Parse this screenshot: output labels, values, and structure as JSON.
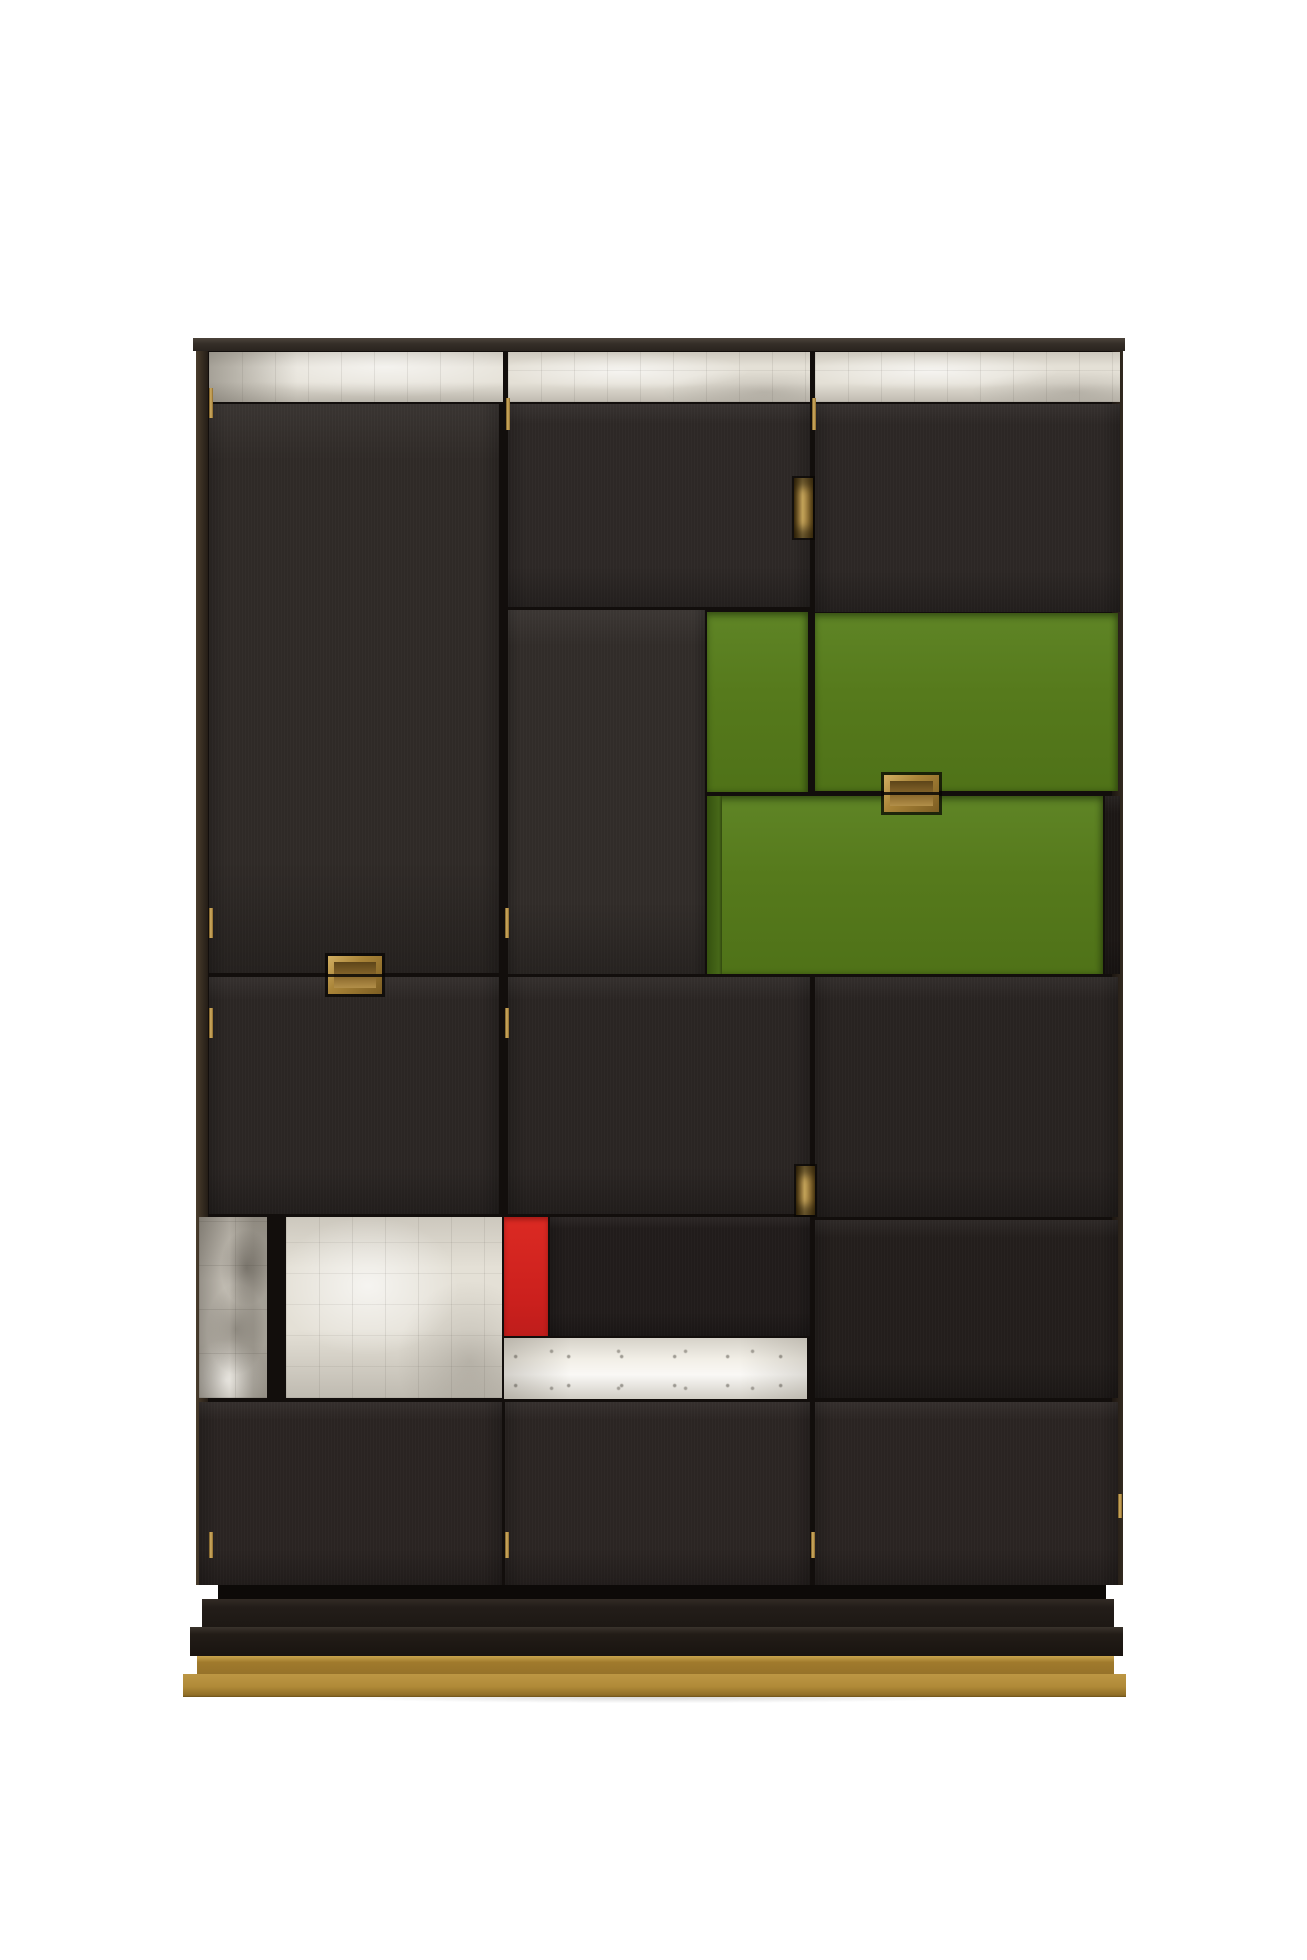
{
  "scene": {
    "type": "product-photograph",
    "description": "Tall dark-stained wood cabinet photographed on a white background, with a Mondrian-style patchwork facade: a silver-leaf band across the top, green lacquered doors and a green drawer at the upper right, silver-leaf panels and a bright silver strip at the lower left, a small red lacquer panel in the center, recessed brass handles and hinge pins, on a stepped black plinth with a brass foot.",
    "background_color": "#ffffff"
  },
  "cabinet": {
    "structure": {
      "columns": 3,
      "top_band_material": "silver leaf",
      "body_material": "ebonized dark-stained wood",
      "accent_panels": [
        "green lacquer upper door (small)",
        "green lacquer upper door (large)",
        "green lacquer drawer front",
        "red lacquer panel",
        "silver leaf mottled panel (lower left)",
        "silver leaf bright panel (lower left)",
        "silver leaf bright strip (lower middle)"
      ],
      "base": "stepped dark plinth with brass foot"
    },
    "hardware": {
      "finish": "brass",
      "handles": 4,
      "hinge_pins": 11
    }
  },
  "palette": {
    "background": "#ffffff",
    "wood_dark": "#2b2523",
    "wood_top_board": "#352e28",
    "silver_leaf": "#e4e0d6",
    "silver_leaf_mottled": "#c9c4ba",
    "silver_leaf_strip": "#f2efe7",
    "green_lacquer": "#567a1c",
    "red_lacquer": "#cb201d",
    "brass": "#b08a38"
  }
}
